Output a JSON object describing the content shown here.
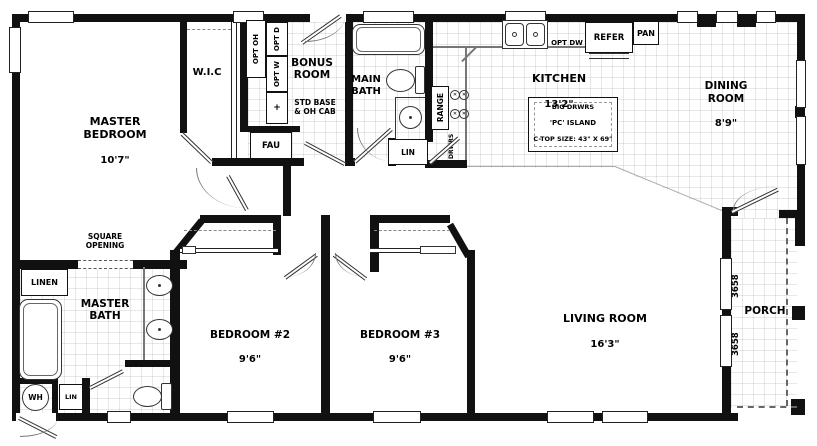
{
  "rooms": {
    "master_bedroom": {
      "name": "MASTER\nBEDROOM",
      "dim": "10'7\""
    },
    "wic": {
      "name": "W.I.C"
    },
    "bonus_room": {
      "name": "BONUS\nROOM"
    },
    "main_bath": {
      "name": "MAIN\nBATH"
    },
    "kitchen": {
      "name": "KITCHEN",
      "dim": "13'2\""
    },
    "dining_room": {
      "name": "DINING\nROOM",
      "dim": "8'9\""
    },
    "master_bath": {
      "name": "MASTER\nBATH"
    },
    "bedroom_2": {
      "name": "BEDROOM #2",
      "dim": "9'6\""
    },
    "bedroom_3": {
      "name": "BEDROOM #3",
      "dim": "9'6\""
    },
    "living_room": {
      "name": "LIVING ROOM",
      "dim": "16'3\""
    },
    "porch": {
      "name": "PORCH"
    }
  },
  "fixtures": {
    "opt_oh": "OPT OH",
    "opt_d": "OPT D",
    "opt_w": "OPT W",
    "base_cross": "+",
    "std_base_note": "STD BASE\n& OH CAB",
    "fau": "FAU",
    "range": "RANGE",
    "drwrs": "DRWRS",
    "opt_dw": "OPT DW",
    "refer": "REFER",
    "pan": "PAN",
    "island_line1": "BIG DRWRS",
    "island_line2": "'PC' ISLAND",
    "island_line3": "C-TOP SIZE: 43\" X 69\"",
    "square_opening": "SQUARE\nOPENING",
    "linen": "LINEN",
    "lin_hall": "LIN",
    "lin_utility": "LIN",
    "wh": "WH",
    "window_label_1": "3658",
    "window_label_2": "3658"
  },
  "colors": {
    "wall": "#111111",
    "grid": "#e5e5e5",
    "door_line": "#333333"
  }
}
